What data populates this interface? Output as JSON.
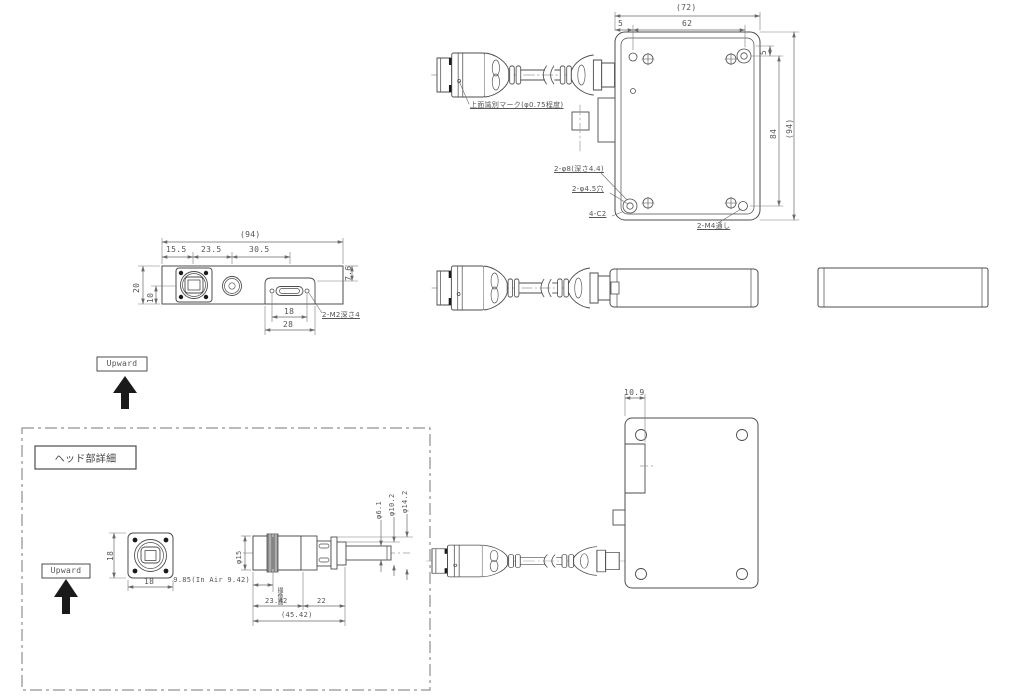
{
  "drawing": {
    "orientation_label": "Upward",
    "top_view": {
      "dim_overall_w": "(72)",
      "dim_edge": "5",
      "dim_pitch_w": "62",
      "dim_edge_v": "5",
      "dim_pitch_h": "84",
      "dim_overall_h": "(94)",
      "note_id_mark": "上面識別マーク(φ0.75程度)",
      "note_counterbore": "2-φ8(深さ4.4)",
      "note_hole": "2-φ4.5穴",
      "note_chamfer": "4-C2",
      "note_thread": "2-M4通し"
    },
    "front_view": {
      "dim_overall": "(94)",
      "dim_seg1": "15.5",
      "dim_seg2": "23.5",
      "dim_seg3": "30.5",
      "dim_height": "20",
      "dim_center": "10",
      "dim_step": "7.6",
      "dim_conn_pitch": "18",
      "dim_boss_w": "28",
      "note_thread": "2-M2深さ4"
    },
    "bottom_view": {
      "dim_block": "10.9"
    },
    "head_detail": {
      "title": "ヘッド部詳細",
      "dim_h": "18",
      "dim_w": "18",
      "dim_flange_depth": "9.85(In Air 9.42)",
      "note_image_plane": "撮像面",
      "dim_len1": "23.42",
      "dim_len2": "22",
      "dim_overall": "(45.42)",
      "dia_body": "φ15",
      "dia_tube": "φ6.1",
      "dia_collar": "φ10.2",
      "dia_ring": "φ14.2"
    },
    "colors": {
      "line": "#4d4d4d",
      "text": "#555555",
      "background": "#ffffff",
      "fill_dark": "#1a1a1a"
    }
  }
}
